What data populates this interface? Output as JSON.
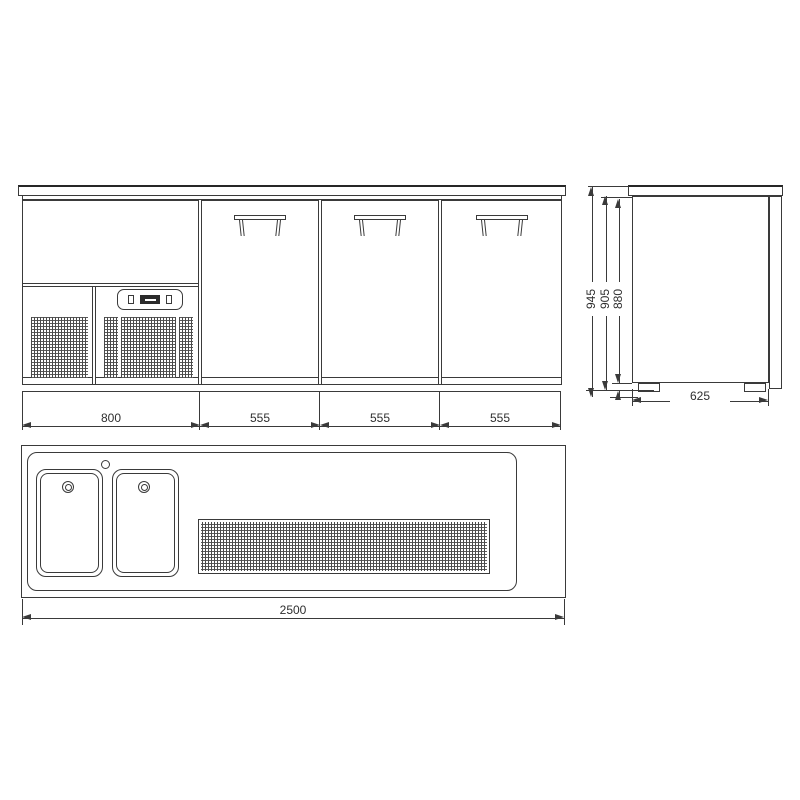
{
  "drawing": {
    "type": "technical-drawing",
    "subject": "refrigerated bar counter with sinks",
    "colors": {
      "line": "#3a3a3a",
      "background": "#ffffff"
    }
  },
  "views": {
    "front": {
      "dim_labels": [
        "800",
        "555",
        "555",
        "555"
      ]
    },
    "side": {
      "height_labels": [
        "945",
        "905",
        "880"
      ],
      "depth_label": "625"
    },
    "top": {
      "width_label": "2500"
    }
  },
  "icons": {
    "door-handle": "css-shape",
    "ventilation-grille": "css-pattern",
    "control-panel-display": "css-shape",
    "sink-basin": "rounded-rect",
    "drain-hole": "circle",
    "tap-hole": "circle",
    "adjustable-foot": "rect",
    "dimension-arrow": "triangle"
  }
}
